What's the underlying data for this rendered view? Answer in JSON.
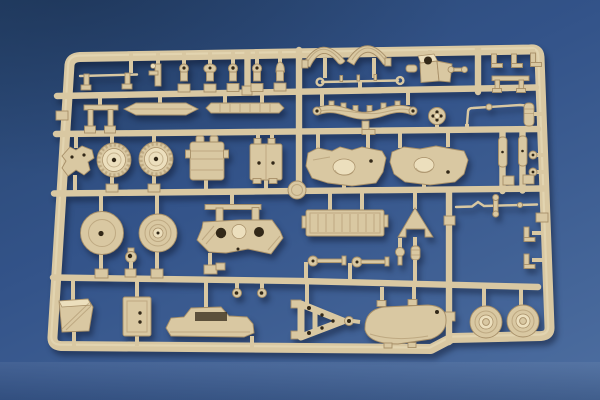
{
  "scene": {
    "title": "Tan plastic model-kit sprue (parts tree) photographed on a blue surface",
    "subject": "injection-molded styrene sprue with military vehicle model parts",
    "background": "blue tabletop with soft gradient lighting"
  },
  "palette": {
    "bg-dark": "#28466f",
    "bg-mid": "#335389",
    "bg-light": "#4d6ea0",
    "plastic": "#d9c8a2",
    "plastic-light": "#ecdfbd",
    "plastic-dark": "#a78f68",
    "hole": "#322818",
    "shadow": "rgba(10,20,42,0.45)"
  },
  "parts": [
    {
      "id": "sprue-frame",
      "label": "rounded rectangular sprue frame with stepped bottom rail"
    },
    {
      "id": "runner-grid",
      "label": "horizontal and vertical runner bars"
    },
    {
      "id": "part-railing",
      "label": "railing with two posts"
    },
    {
      "id": "part-small-bracket",
      "label": "small winch bracket"
    },
    {
      "id": "part-knob-row",
      "label": "row of five small pins and shackles"
    },
    {
      "id": "part-fenders",
      "label": "pair of curved fender arches"
    },
    {
      "id": "part-mount-bracket",
      "label": "angled mount bracket with hole"
    },
    {
      "id": "part-link",
      "label": "small link rod"
    },
    {
      "id": "part-top-clips",
      "label": "three L-shaped clips"
    },
    {
      "id": "part-bench",
      "label": "bench-shaped bracket"
    },
    {
      "id": "part-handrail-rod",
      "label": "thin handrail rod with ring ends"
    },
    {
      "id": "part-goalpost",
      "label": "U-shaped frame bracket"
    },
    {
      "id": "part-boat-spring",
      "label": "small leaf-spring blade"
    },
    {
      "id": "part-segmented-bar",
      "label": "segmented tread bar"
    },
    {
      "id": "part-leaf-spring",
      "label": "large multi-leaf spring with clamps"
    },
    {
      "id": "part-pulley",
      "label": "pulley wheel with four holes"
    },
    {
      "id": "part-bent-rod",
      "label": "bent tie rod"
    },
    {
      "id": "part-cylinder",
      "label": "ribbed cylinder"
    },
    {
      "id": "part-rail-bolts",
      "label": "bolt heads on right rail"
    },
    {
      "id": "part-bracket-x",
      "label": "four-legged bracket"
    },
    {
      "id": "part-sprocket-1",
      "label": "toothed drive sprocket wheel"
    },
    {
      "id": "part-sprocket-2",
      "label": "toothed drive sprocket wheel"
    },
    {
      "id": "part-canister",
      "label": "tank canister with filler caps"
    },
    {
      "id": "part-box",
      "label": "stowage box with bolt holes"
    },
    {
      "id": "part-junction-disc",
      "label": "round disc on runner junction"
    },
    {
      "id": "part-hull-left",
      "label": "hull half with turret opening"
    },
    {
      "id": "part-hull-right",
      "label": "hull half with hatch"
    },
    {
      "id": "part-strips",
      "label": "two narrow strip parts on vertical runners"
    },
    {
      "id": "part-disc-large",
      "label": "large plain road wheel with center hole"
    },
    {
      "id": "part-disc-ribbed",
      "label": "large ribbed road wheel with hub"
    },
    {
      "id": "part-ring",
      "label": "small towing ring"
    },
    {
      "id": "part-bogie",
      "label": "suspension bogie with two holes"
    },
    {
      "id": "part-hook-rings",
      "label": "two small hook rings"
    },
    {
      "id": "part-ribbed-plate",
      "label": "ribbed floor plate"
    },
    {
      "id": "part-funnel",
      "label": "triangular funnel plate"
    },
    {
      "id": "part-axles",
      "label": "axle pins with disc heads"
    },
    {
      "id": "part-tie-rod",
      "label": "tie rod with ball joints"
    },
    {
      "id": "part-side-clips",
      "label": "L-clips on right rail"
    },
    {
      "id": "part-wedge",
      "label": "wedge mudguard"
    },
    {
      "id": "part-door",
      "label": "hatch door panel"
    },
    {
      "id": "part-fairing",
      "label": "vehicle side fairing with cutout"
    },
    {
      "id": "part-towbar",
      "label": "A-frame tow bar with lunette ring"
    },
    {
      "id": "part-body",
      "label": "rounded body shell"
    },
    {
      "id": "part-wheel-1",
      "label": "road wheel with stepped hub"
    },
    {
      "id": "part-wheel-2",
      "label": "road wheel with stepped hub"
    }
  ]
}
